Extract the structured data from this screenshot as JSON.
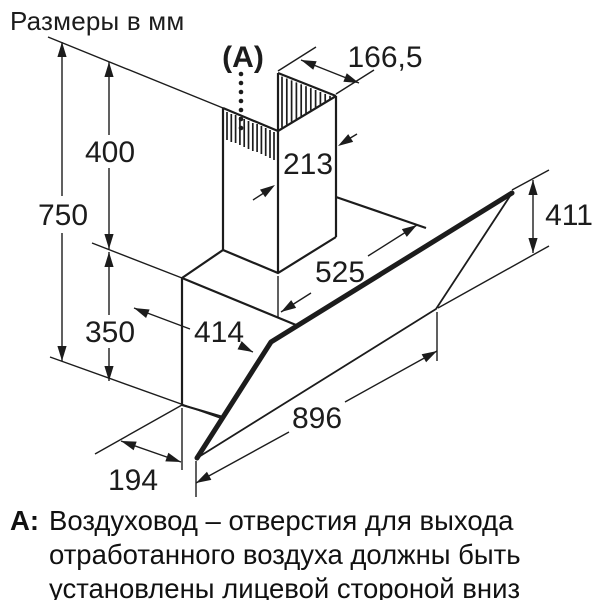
{
  "title": "Размеры в мм",
  "dimensions": {
    "vent_ref": "(A)",
    "chimney_width": "166,5",
    "chimney_depth": "213",
    "height_total": "750",
    "height_chimney": "400",
    "height_body": "350",
    "top_width": "525",
    "body_depth": "414",
    "panel_height": "411",
    "panel_width": "896",
    "bottom_offset": "194"
  },
  "note": {
    "prefix": "A:",
    "lines": [
      "Воздуховод – отверстия для выхода",
      "отработанного воздуха должны быть",
      "установлены лицевой стороной вниз"
    ]
  },
  "colors": {
    "ink": "#1c1c1c",
    "background": "#ffffff"
  }
}
